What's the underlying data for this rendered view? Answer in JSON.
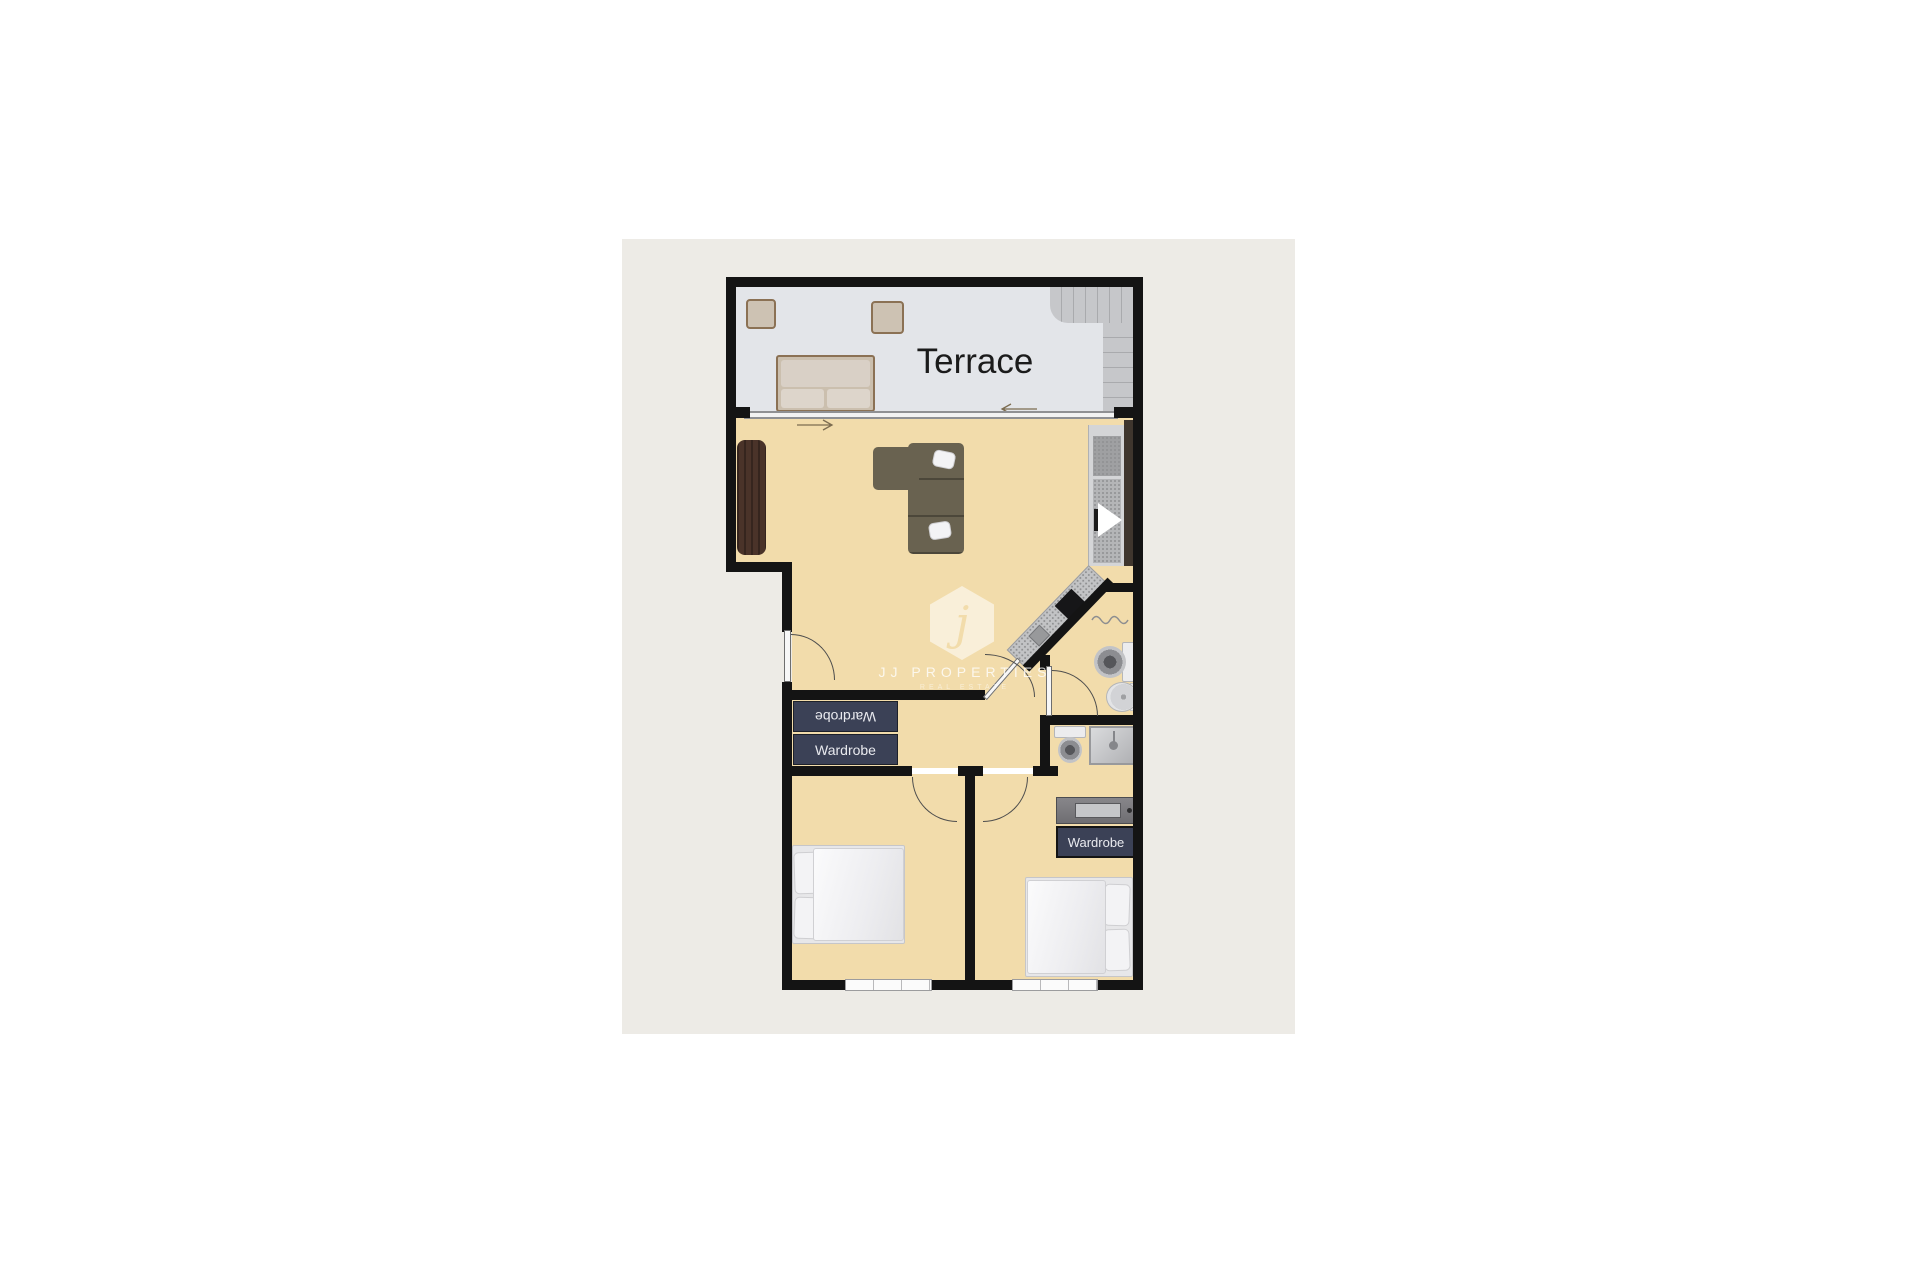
{
  "floorplan": {
    "rooms": {
      "terrace_label": "Terrace"
    },
    "closet": {
      "wardrobe_top_label": "Wardrobe",
      "wardrobe_bottom_label": "Wardrobe"
    },
    "bedroom_right": {
      "wardrobe_label": "Wardrobe"
    },
    "watermark": {
      "monogram": "j",
      "brand": "JJ PROPERTIES",
      "tagline": "REAL ESTATE"
    },
    "icons": {
      "arrow_right": "entry direction arrow",
      "arrow_left": "stair/terrace direction arrow",
      "shower_head": "shower head",
      "towel_rail": "towel rail wave"
    },
    "colors": {
      "page_bg": "#ffffff",
      "card_bg": "#edebe6",
      "wall": "#141414",
      "floor_interior": "#f2dcab",
      "floor_terrace": "#e3e5e9",
      "stairs": "#c6c7ca",
      "wardrobe_navy": "#3b4156",
      "sofa_olive": "#696250",
      "wood_dark": "#4a3329",
      "fixture_gray": "#c9cacd",
      "label_dark": "#1b1b1b"
    }
  }
}
